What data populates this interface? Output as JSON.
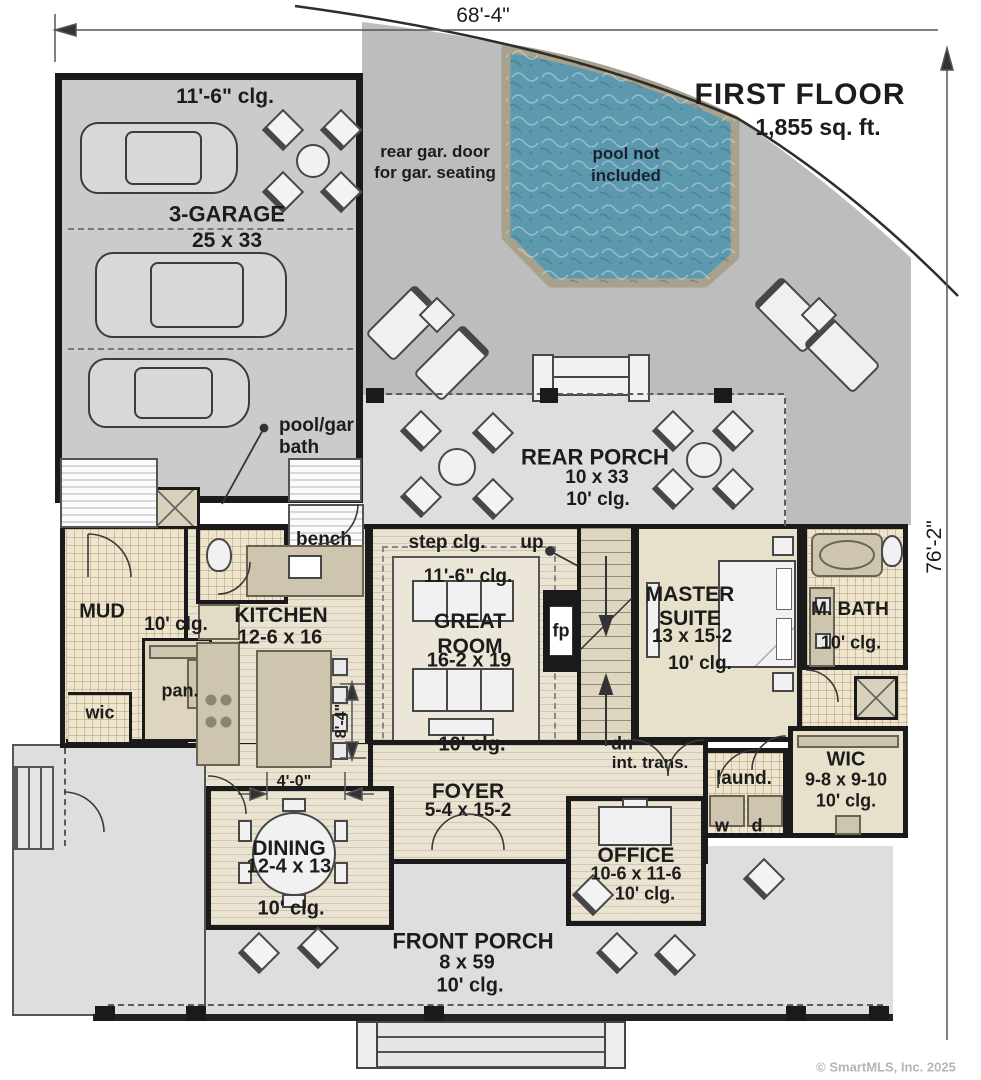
{
  "header": {
    "title": "FIRST FLOOR",
    "area": "1,855 sq. ft."
  },
  "dimensions": {
    "overall_width": "68'-4\"",
    "overall_depth": "76'-2\"",
    "kitchen_island": "8'-4\"",
    "dining_opening": "4'-0\""
  },
  "annotations": {
    "rear_gar_door": "rear gar. door for gar. seating",
    "pool_note": "pool not included",
    "pool_gar_bath": "pool/gar bath",
    "bench": "bench",
    "step_clg": "step clg.",
    "up": "up",
    "dn": "dn",
    "fp": "fp",
    "int_trans": "int. trans.",
    "washer": "w",
    "dryer": "d"
  },
  "rooms": {
    "garage": {
      "clg": "11'-6\" clg.",
      "name": "3-GARAGE",
      "size": "25 x 33"
    },
    "rear_porch": {
      "name": "REAR PORCH",
      "size": "10 x 33",
      "clg": "10' clg."
    },
    "great_room": {
      "clg": "11'-6\" clg.",
      "name": "GREAT ROOM",
      "size": "16-2 x 19",
      "clg2": "10' clg."
    },
    "kitchen": {
      "name": "KITCHEN",
      "size": "12-6 x 16"
    },
    "mud": {
      "name": "MUD"
    },
    "hall": {
      "clg": "10' clg."
    },
    "wic_small": {
      "name": "wic"
    },
    "pantry": {
      "name": "pan."
    },
    "master_suite": {
      "name": "MASTER SUITE",
      "size": "13 x 15-2",
      "clg": "10' clg."
    },
    "master_bath": {
      "name": "M. BATH",
      "clg": "10' clg."
    },
    "wic": {
      "name": "WIC",
      "size": "9-8 x 9-10",
      "clg": "10' clg."
    },
    "laundry": {
      "name": "laund."
    },
    "foyer": {
      "name": "FOYER",
      "size": "5-4 x 15-2"
    },
    "dining": {
      "name": "DINING",
      "size": "12-4 x 13",
      "clg": "10' clg."
    },
    "office": {
      "name": "OFFICE",
      "size": "10-6 x 11-6",
      "clg": "10' clg."
    },
    "front_porch": {
      "name": "FRONT PORCH",
      "size": "8 x 59",
      "clg": "10' clg."
    }
  },
  "footer": {
    "copyright": "© SmartMLS, Inc.  2025"
  },
  "colors": {
    "pool_water": "#5d99ae",
    "pool_deck_border": "#a8a18b",
    "patio": "#bdbdbd",
    "porch": "#dedede",
    "garage_floor": "#cbcbcb",
    "wood_floor": "#eae3d1",
    "tile_floor": "#efe5cd",
    "carpet": "#e7e0ca",
    "wall": "#1a1a1a"
  }
}
